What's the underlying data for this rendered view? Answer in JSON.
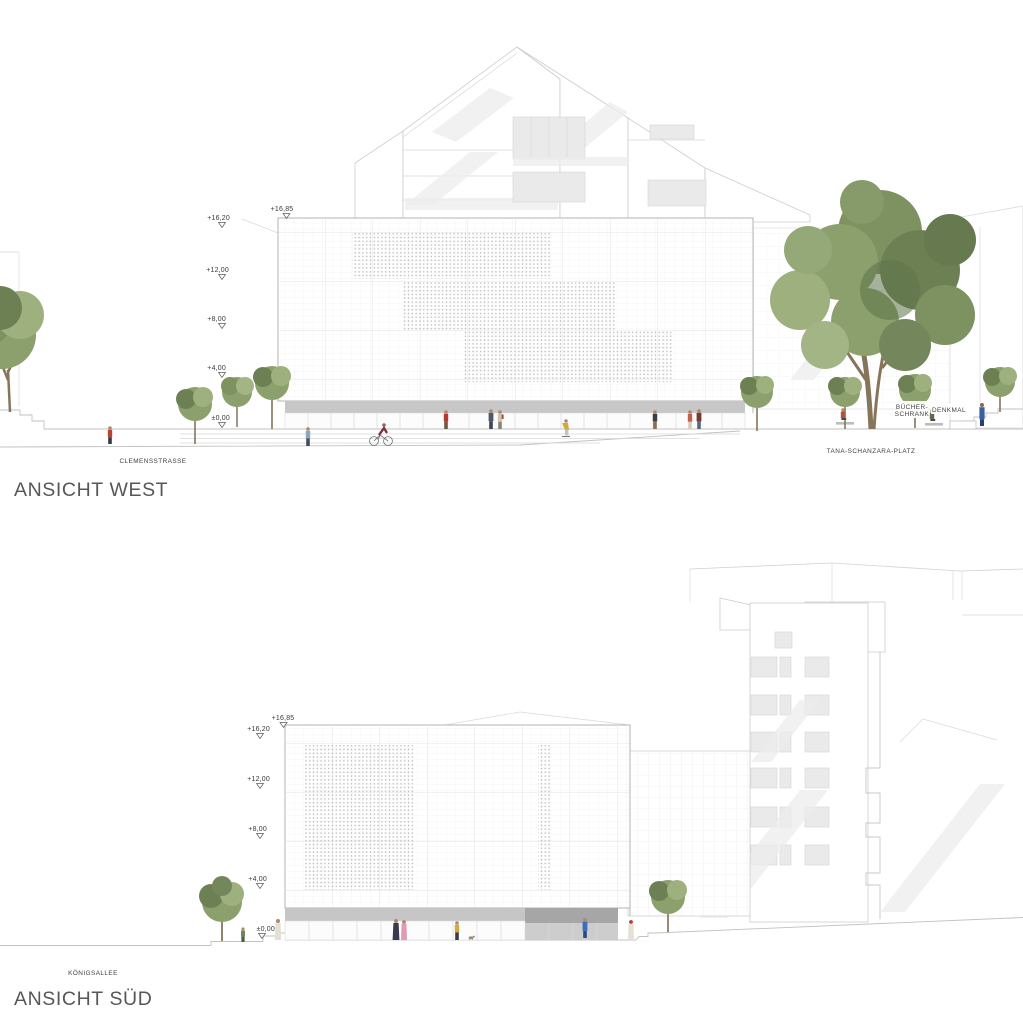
{
  "sheet": {
    "titles": {
      "west": "ANSICHT WEST",
      "sued": "ANSICHT SÜD"
    },
    "colors": {
      "base_band": "#c6c6c6",
      "dark_base": "#a6a6a6",
      "tree_green": "#7e9161",
      "line_gray": "#cfcfcf",
      "text_gray": "#575757"
    }
  },
  "west": {
    "street": "CLEMENSSTRASSE",
    "plaza": "TANA-SCHANZARA-PLATZ",
    "bookcase_line1": "BÜCHER-",
    "bookcase_line2": "SCHRANK",
    "monument": "DENKMAL",
    "levels": {
      "l1685": "+16,85",
      "l1620": "+16,20",
      "l1200": "+12,00",
      "l800": "+8,00",
      "l400": "+4,00",
      "l0": "±0,00"
    }
  },
  "sued": {
    "street": "KÖNIGSALLEE",
    "levels": {
      "l1685": "+16,85",
      "l1620": "+16,20",
      "l1200": "+12,00",
      "l800": "+8,00",
      "l400": "+4,00",
      "l0": "±0,00"
    }
  }
}
